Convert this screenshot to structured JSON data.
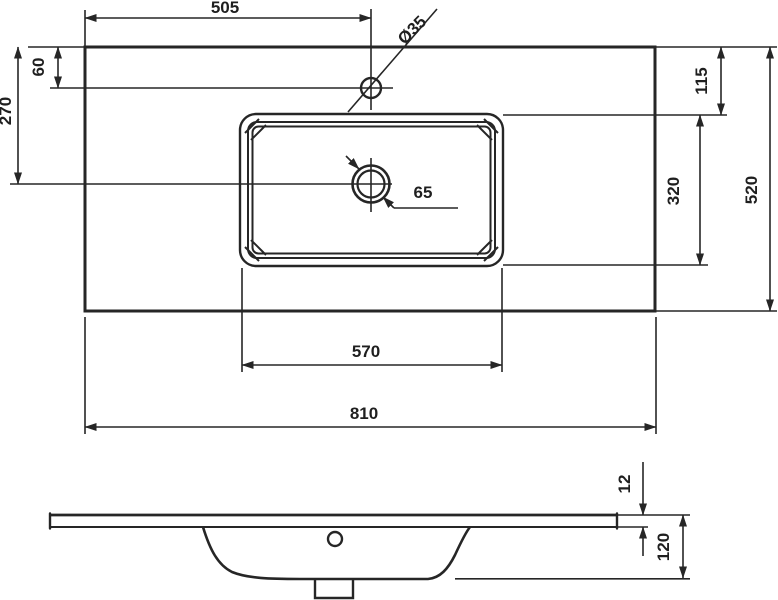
{
  "diagram": {
    "kind": "technical-drawing",
    "subject": "rectangular inset washbasin / vanity top, plan view and side section, dimensions in mm",
    "line_color": "#262626",
    "background_color": "#ffffff"
  },
  "dims": {
    "d505": "505",
    "d35": "Ø35",
    "d60": "60",
    "d270": "270",
    "d115": "115",
    "d320": "320",
    "d520": "520",
    "d570": "570",
    "d810": "810",
    "d65": "65",
    "d12": "12",
    "d120": "120"
  }
}
